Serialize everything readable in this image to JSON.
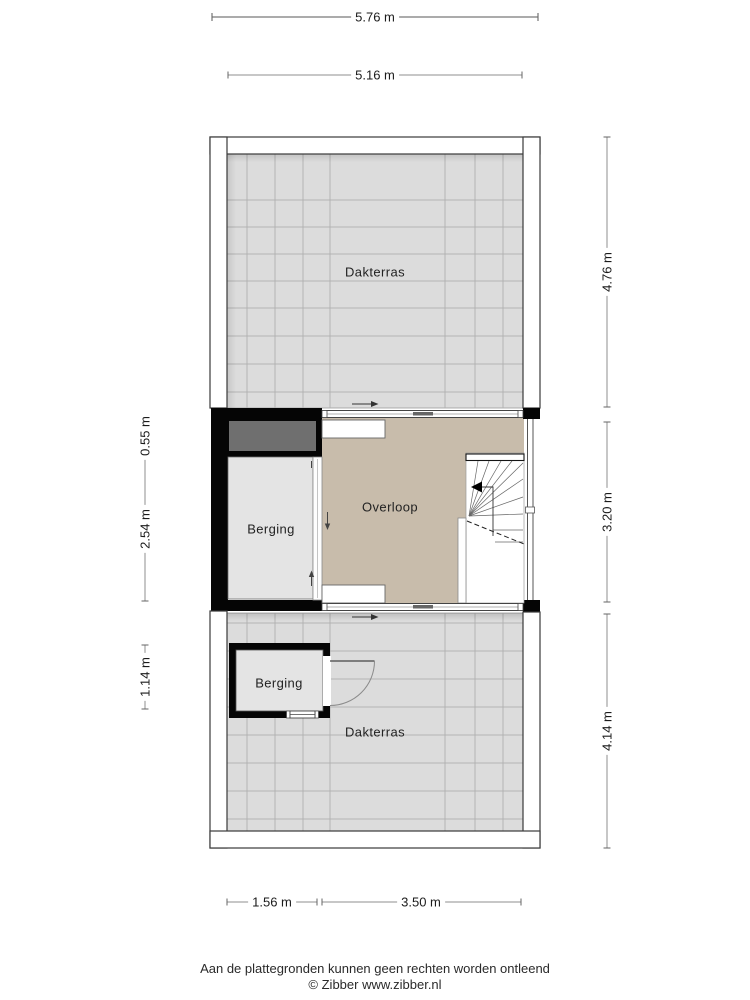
{
  "floorplan": {
    "rooms": {
      "dakterras_top": "Dakterras",
      "overloop": "Overloop",
      "berging_middle": "Berging",
      "berging_bottom": "Berging",
      "dakterras_bottom": "Dakterras"
    },
    "dimensions": {
      "top_outer": "5.76 m",
      "top_inner": "5.16 m",
      "right_top": "4.76 m",
      "right_middle": "3.20 m",
      "right_bottom": "4.14 m",
      "left_top": "0.55 m",
      "left_middle": "2.54 m",
      "left_bottom": "1.14 m",
      "bottom_left": "1.56 m",
      "bottom_right": "3.50 m"
    },
    "colors": {
      "tile_floor": "#dcdcdc",
      "tile_grid": "#b3b3b3",
      "overloop_floor": "#c8bcab",
      "berging_floor": "#e4e4e4",
      "wall_black": "#050505",
      "roof_strip_gray": "#6f6f6f",
      "wall_outline": "#3a3a3a",
      "dimension_line": "#8f8f8f"
    },
    "footer": {
      "line1": "Aan de plattegronden kunnen geen rechten worden ontleend",
      "line2": "© Zibber www.zibber.nl"
    }
  }
}
